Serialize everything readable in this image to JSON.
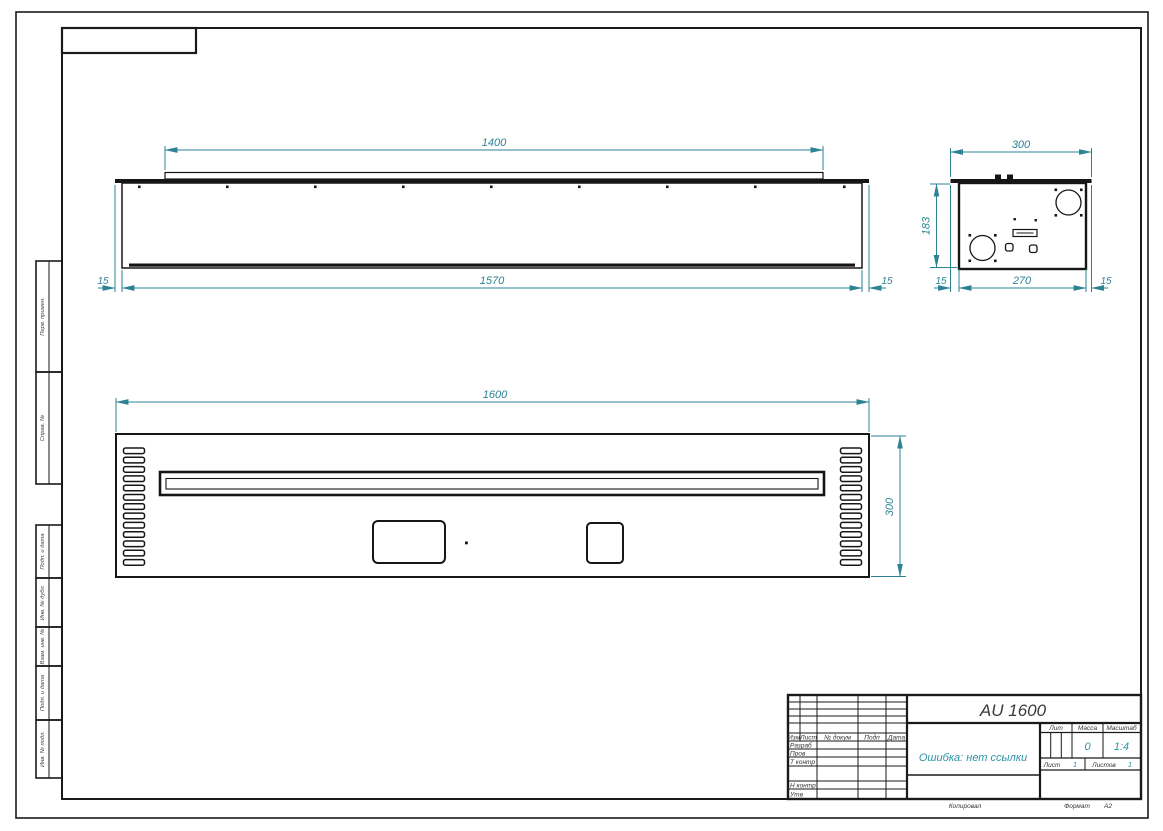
{
  "drawing": {
    "title": "AU 1600",
    "doc_note": "Ошибка: нет ссылки",
    "mass": "0",
    "scale": "1:4",
    "sheet": "1",
    "sheets": "1",
    "format": "А2"
  },
  "dims": {
    "top_view": {
      "inner_width": "1400",
      "body_width": "1570",
      "left_offset": "15",
      "right_offset": "15"
    },
    "side_view": {
      "width": "300",
      "height": "183",
      "left_offset": "15",
      "inner_width": "270",
      "right_offset": "15"
    },
    "front_view": {
      "width": "1600",
      "height": "300"
    }
  },
  "title_block": {
    "header_cols": [
      "Изм",
      "Лист",
      "№ докум",
      "Подп",
      "Дата"
    ],
    "role_rows": [
      "Разраб",
      "Пров",
      "Т контр",
      "Н контр",
      "Утв"
    ],
    "lit_label": "Лит",
    "mass_label": "Масса",
    "scale_label": "Масштаб",
    "sheet_label": "Лист",
    "sheets_label": "Листов",
    "copied_label": "Копировал",
    "format_label": "Формат"
  },
  "margin_labels": {
    "perv_primen": "Перв. примен.",
    "sprav_no": "Справ. №",
    "podp_data_1": "Подп. и дата",
    "inv_dubl": "Инв. № дубл.",
    "vzam_inv": "Взам. инв. №",
    "podp_data_2": "Подп. и дата",
    "inv_podl": "Инв. № подл."
  },
  "colors": {
    "dimension_line": "#2d8394",
    "object_line": "#161616",
    "accent_value": "#2b93a6"
  }
}
